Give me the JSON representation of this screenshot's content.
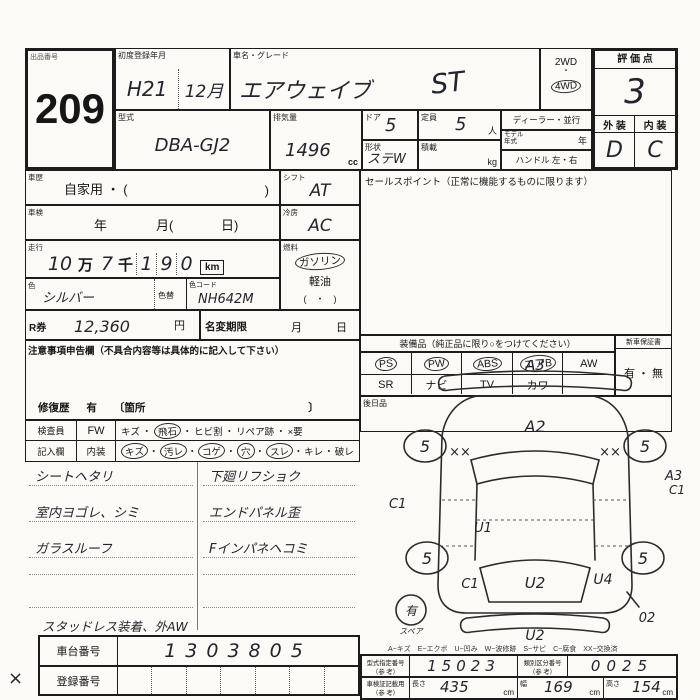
{
  "sep": "・",
  "lot": {
    "label": "出品番号",
    "number": "209"
  },
  "reg": {
    "label": "初度登録年月",
    "era": "H21",
    "month": "12月"
  },
  "carname": {
    "label": "車名・グレード",
    "value": "エアウェイブ",
    "grade": "ST"
  },
  "drive": {
    "opt1": "2WD",
    "opt2": "4WD",
    "selected": "4WD"
  },
  "score": {
    "label": "評 価 点",
    "value": "3",
    "ext_label": "外 装",
    "int_label": "内 装",
    "ext_value": "D",
    "int_value": "C"
  },
  "model": {
    "label": "型式",
    "value": "DBA-GJ2"
  },
  "disp": {
    "label": "排気量",
    "value": "1496",
    "unit": "cc"
  },
  "doors": {
    "label": "ドア",
    "value": "5"
  },
  "capacity": {
    "label": "定員",
    "value": "5",
    "unit": "人"
  },
  "shape": {
    "label": "形状",
    "value": "ステW"
  },
  "load": {
    "label": "積載",
    "unit": "kg"
  },
  "dealer": {
    "label": "ディーラー・並行"
  },
  "modelyear": {
    "label": "モデル",
    "label2": "年式",
    "unit": "年"
  },
  "handle": {
    "label": "ハンドル 左・右"
  },
  "history": {
    "label": "車歴",
    "value": "自家用 ・ (",
    "close": ")"
  },
  "shaken": {
    "label": "車検",
    "year": "年",
    "month": "月(",
    "day": "日)"
  },
  "mileage": {
    "label": "走行",
    "man_digits": "10",
    "man": "万",
    "sen_digit": "7",
    "sen": "千",
    "d1": "1",
    "d2": "9",
    "d3": "0",
    "unit": "km"
  },
  "color": {
    "label": "色",
    "value": "シルバー",
    "change_label": "色替",
    "code_label": "色コード",
    "code_value": "NH642M"
  },
  "shift": {
    "label": "シフト",
    "value": "AT"
  },
  "ac": {
    "label": "冷房",
    "value": "AC"
  },
  "fuel": {
    "label": "燃料",
    "gasoline": "ガソリン",
    "diesel": "軽油",
    "paren": "(　・　)",
    "selected": "ガソリン"
  },
  "sales": {
    "label": "セールスポイント（正常に機能するものに限ります）"
  },
  "equipment": {
    "header": "装備品（純正品に限り○をつけてください）",
    "row1": [
      {
        "label": "PS",
        "circled": true
      },
      {
        "label": "PW",
        "circled": true
      },
      {
        "label": "ABS",
        "circled": true
      },
      {
        "label": "エアB",
        "circled": true
      },
      {
        "label": "AW",
        "circled": false
      }
    ],
    "row2": [
      {
        "label": "SR",
        "circled": false
      },
      {
        "label": "ナビ",
        "circled": false
      },
      {
        "label": "TV",
        "circled": false
      },
      {
        "label": "カワ",
        "circled": false
      },
      {
        "label": "",
        "circled": false
      }
    ],
    "warranty": {
      "label": "新車保証書",
      "value": "有 ・ 無"
    },
    "later_label": "後日品"
  },
  "rticket": {
    "label": "R券",
    "value": "12,360",
    "unit": "円"
  },
  "namechange": {
    "label": "名変期限",
    "month": "月",
    "day": "日"
  },
  "caution": {
    "label": "注意事項申告欄（不具合内容等は具体的に記入して下さい）",
    "repair_label": "修復歴",
    "repair_value": "有",
    "bracket": "〔箇所",
    "bracket_close": "〕"
  },
  "inspect_row1": {
    "label": "検査員",
    "cell": "FW",
    "items": [
      {
        "t": "キズ",
        "circled": false
      },
      {
        "t": "飛石",
        "circled": true
      },
      {
        "t": "ヒビ割",
        "circled": false
      },
      {
        "t": "リペア跡",
        "circled": false
      },
      {
        "t": "×要",
        "circled": false
      }
    ]
  },
  "inspect_row2": {
    "label": "記入欄",
    "cell": "内装",
    "items": [
      {
        "t": "キズ",
        "circled": true
      },
      {
        "t": "汚レ",
        "circled": true
      },
      {
        "t": "コゲ",
        "circled": true
      },
      {
        "t": "穴",
        "circled": true
      },
      {
        "t": "スレ",
        "circled": true
      },
      {
        "t": "キレ",
        "circled": false
      },
      {
        "t": "破レ",
        "circled": false
      }
    ]
  },
  "notes": {
    "left": [
      "シートヘタリ",
      "室内ヨゴレ、シミ",
      "ガラスルーフ"
    ],
    "right": [
      "下廻リフショク",
      "エンドパネル歪",
      "Fインパネヘコミ"
    ],
    "extra": "スタッドレス装着、外AW"
  },
  "chassis": {
    "label": "車台番号",
    "value": "1303805"
  },
  "regno": {
    "label": "登録番号",
    "mark": "×"
  },
  "diagram": {
    "legend": "A−キズ　E−エクボ　U−凹み　W−波修跡　S−サビ　C−腐食　XX−交換済",
    "front_bumper": "A3",
    "hood": "A2",
    "lf_fender": "××",
    "rf_fender": "××",
    "lf_wheel": "5",
    "rf_wheel": "5",
    "lr_wheel": "5",
    "rr_wheel": "5",
    "left_side": "C1",
    "left_rear_door": "U1",
    "left_rear_fender": "C1",
    "tailgate": "U2",
    "rear_bumper": "U2",
    "rr_fender": "U4",
    "rr_corner": "02",
    "right_side_a": "A3",
    "right_side_b": "C1",
    "spare": "有",
    "spare_label": "スペア"
  },
  "specs": {
    "type_label": "型式指定番号",
    "ref": "（参 考）",
    "type_value": "15023",
    "class_label": "類別区分番号",
    "class_value": "0025",
    "doc_label": "車検証記載用",
    "length_label": "長さ",
    "length_value": "435",
    "width_label": "幅",
    "width_value": "169",
    "height_label": "高さ",
    "height_value": "154",
    "unit": "cm"
  }
}
